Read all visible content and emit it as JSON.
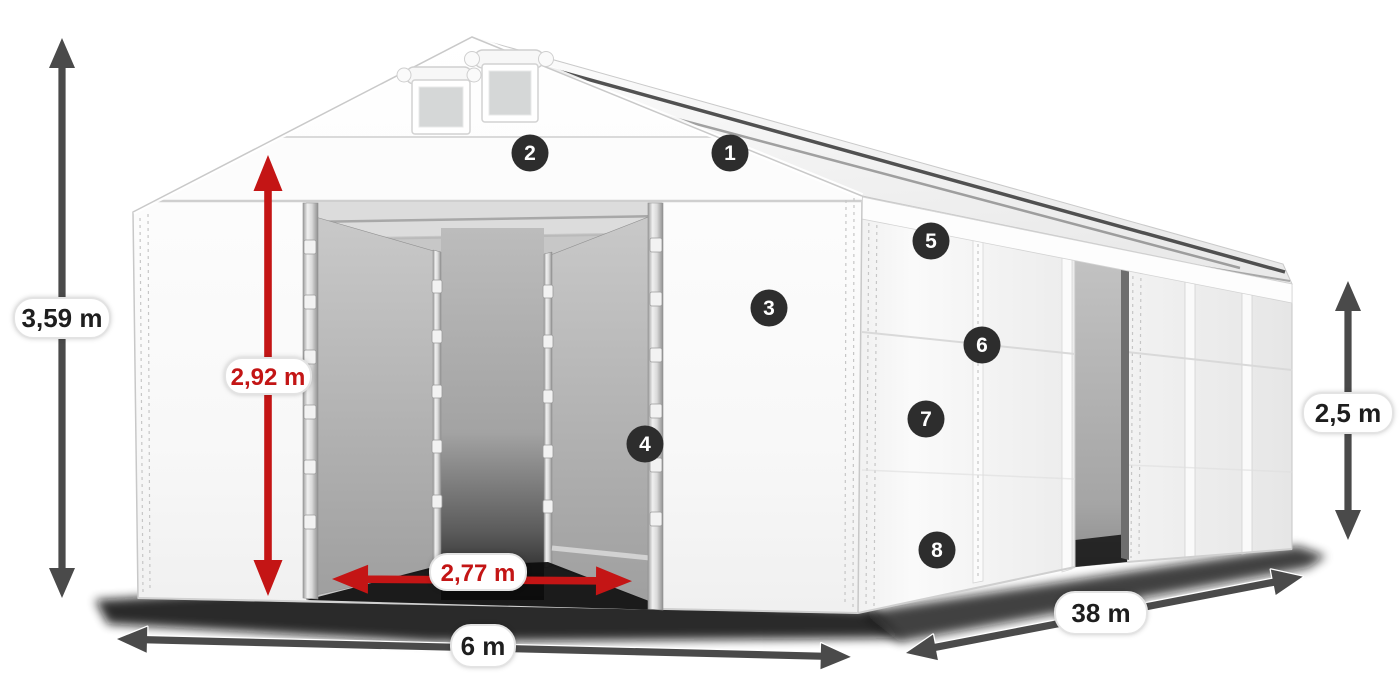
{
  "diagram": {
    "kind": "product-dimension-diagram",
    "subject": "white-gabled-storage-tent",
    "dimensions": {
      "total_height": {
        "value": "3,59 m",
        "text_color": "#1e1e1e"
      },
      "entrance_height": {
        "value": "2,92 m",
        "text_color": "#c31515"
      },
      "entrance_width": {
        "value": "2,77 m",
        "text_color": "#c31515"
      },
      "width": {
        "value": "6 m",
        "text_color": "#1e1e1e"
      },
      "length": {
        "value": "38 m",
        "text_color": "#1e1e1e"
      },
      "side_height": {
        "value": "2,5 m",
        "text_color": "#1e1e1e"
      }
    },
    "markers": [
      {
        "number": "1"
      },
      {
        "number": "2"
      },
      {
        "number": "3"
      },
      {
        "number": "4"
      },
      {
        "number": "5"
      },
      {
        "number": "6"
      },
      {
        "number": "7"
      },
      {
        "number": "8"
      }
    ],
    "colors": {
      "dimension_arrow": "#4a4a4a",
      "highlight_arrow": "#c41515",
      "marker_background": "#2d2d2d",
      "marker_number": "#ffffff",
      "label_pill_background": "#ffffff",
      "label_pill_border": "#e3e3e3",
      "tent_fabric": "#f7f7f7",
      "interior_shade": "#a8a8a8"
    }
  }
}
